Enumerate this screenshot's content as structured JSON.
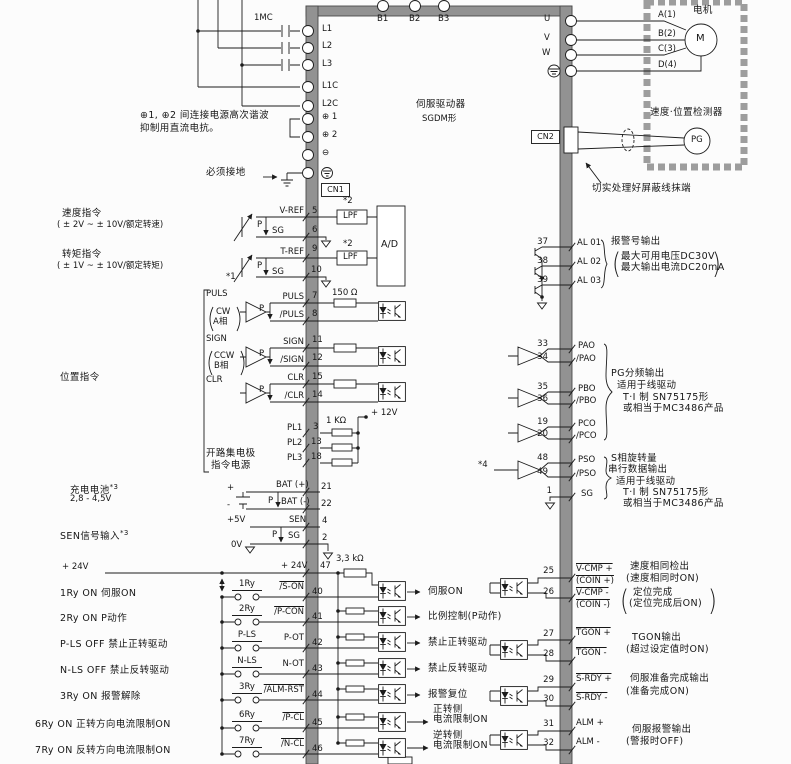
{
  "driver": {
    "title1": "伺服驱动器",
    "title2": "SGDM形",
    "cn1": "CN1",
    "cn2": "CN2",
    "b_terms": [
      "B1",
      "B2",
      "B3"
    ]
  },
  "power": {
    "contactor": "1MC",
    "terminals": [
      "L1",
      "L2",
      "L3",
      "L1C",
      "L2C"
    ],
    "dc_terms": [
      "⊕ 1",
      "⊕ 2",
      "⊖"
    ],
    "reactor_note1": "⊕1, ⊕2 间连接电源高次谐波",
    "reactor_note2": "抑制用直流电抗。",
    "ground_note": "必须接地"
  },
  "motor": {
    "uvw": [
      "U",
      "V",
      "W"
    ],
    "phases": [
      "A(1)",
      "B(2)",
      "C(3)",
      "D(4)"
    ],
    "label": "电机",
    "m": "M",
    "detector": "速度·位置检测器",
    "pg": "PG",
    "shield_note": "切实处理好屏蔽线抹端"
  },
  "analog": {
    "speed_title": "速度指令",
    "speed_range": "( ± 2V ~ ± 10V/额定转速)",
    "torque_title": "转矩指令",
    "torque_range": "( ± 1V ~ ± 10V/额定转矩)",
    "star1": "*1",
    "star2": "*2",
    "lpf": "LPF",
    "ad": "A/D",
    "p": "P",
    "rows": [
      {
        "name": "V-REF",
        "pin": "5"
      },
      {
        "name": "SG",
        "pin": "6"
      },
      {
        "name": "T-REF",
        "pin": "9"
      },
      {
        "name": "SG",
        "pin": "10"
      }
    ]
  },
  "pulse": {
    "section_label": "位置指令",
    "puls": {
      "t": "PULS",
      "s1": "CW",
      "s2": "A相"
    },
    "sign": {
      "t": "SIGN",
      "s1": "CCW",
      "s2": "B相"
    },
    "clr": "CLR",
    "r150": "150 Ω",
    "r1k": "1 KΩ",
    "v12": "+ 12V",
    "p": "P",
    "rows": [
      {
        "name": "PULS",
        "pin": "7"
      },
      {
        "name": "/PULS",
        "pin": "8"
      },
      {
        "name": "SIGN",
        "pin": "11"
      },
      {
        "name": "/SIGN",
        "pin": "12"
      },
      {
        "name": "CLR",
        "pin": "15"
      },
      {
        "name": "/CLR",
        "pin": "14"
      }
    ],
    "pl_rows": [
      {
        "name": "PL1",
        "pin": "3"
      },
      {
        "name": "PL2",
        "pin": "13"
      },
      {
        "name": "PL3",
        "pin": "18"
      }
    ],
    "oc1": "开路集电极",
    "oc2": "指令电源"
  },
  "battery": {
    "label": "充电电池",
    "sup": "*3",
    "range": "2,8 - 4,5V",
    "plus": "+",
    "minus": "-",
    "p": "P",
    "rows": [
      {
        "name": "BAT (+)",
        "pin": "21"
      },
      {
        "name": "BAT (-)",
        "pin": "22"
      }
    ]
  },
  "sen": {
    "label": "SEN信号输入",
    "sup": "*3",
    "v5": "+5V",
    "v0": "0V",
    "p": "P",
    "rows": [
      {
        "name": "SEN",
        "pin": "4"
      },
      {
        "name": "SG",
        "pin": "2"
      }
    ]
  },
  "din": {
    "ext24": "+ 24V",
    "rail24": "+ 24V",
    "pin47": "47",
    "r33": "3,3 kΩ",
    "rows": [
      {
        "ext": "1Ry ON 伺服ON",
        "sw": "1Ry",
        "name": "/S-ON",
        "pin": "40",
        "f1": "伺服ON",
        "f2": ""
      },
      {
        "ext": "2Ry ON P动作",
        "sw": "2Ry",
        "name": "/P-CON",
        "pin": "41",
        "f1": "比例控制(P动作)",
        "f2": ""
      },
      {
        "ext": "P-LS OFF 禁止正转驱动",
        "sw": "P-LS",
        "name": "P-OT",
        "pin": "42",
        "f1": "禁止正转驱动",
        "f2": ""
      },
      {
        "ext": "N-LS OFF 禁止反转驱动",
        "sw": "N-LS",
        "name": "N-OT",
        "pin": "43",
        "f1": "禁止反转驱动",
        "f2": ""
      },
      {
        "ext": "3Ry ON 报警解除",
        "sw": "3Ry",
        "name": "/ALM-RST",
        "pin": "44",
        "f1": "报警复位",
        "f2": ""
      },
      {
        "ext": "6Ry ON 正转方向电流限制ON",
        "sw": "6Ry",
        "name": "/P-CL",
        "pin": "45",
        "f1": "正转侧",
        "f2": "电流限制ON"
      },
      {
        "ext": "7Ry ON 反转方向电流限制ON",
        "sw": "7Ry",
        "name": "/N-CL",
        "pin": "46",
        "f1": "逆转侧",
        "f2": "电流限制ON"
      }
    ]
  },
  "alarm": {
    "rows": [
      {
        "pin": "37",
        "name": "AL 01"
      },
      {
        "pin": "38",
        "name": "AL 02"
      },
      {
        "pin": "39",
        "name": "AL 03"
      }
    ],
    "note": "报警号输出",
    "note2": "最大可用电压DC30V",
    "note3": "最大输出电流DC20mA"
  },
  "pgout": {
    "rows": [
      {
        "pin": "33",
        "name": "PAO"
      },
      {
        "pin": "34",
        "name": "/PAO"
      },
      {
        "pin": "35",
        "name": "PBO"
      },
      {
        "pin": "36",
        "name": "/PBO"
      },
      {
        "pin": "19",
        "name": "PCO"
      },
      {
        "pin": "20",
        "name": "/PCO"
      }
    ],
    "note1": "PG分频输出",
    "note2": "适用于线驱动",
    "note3": "T·I 制 SN75175形",
    "note4": "或相当于MC3486产品",
    "star4": "*4",
    "srows": [
      {
        "pin": "48",
        "name": "PSO"
      },
      {
        "pin": "49",
        "name": "/PSO"
      },
      {
        "pin": "1",
        "name": "SG"
      }
    ],
    "snote1": "S相旋转量",
    "snote2": "串行数据输出",
    "snote3": "适用于线驱动",
    "snote4": "T·I 制 SN75175形",
    "snote5": "或相当于MC3486产品"
  },
  "sout": {
    "g0": {
      "p1": "25",
      "n1": "V-CMP +",
      "s1": "(COIN +)",
      "p2": "26",
      "n2": "V-CMP -",
      "s2": "(COIN -)",
      "note1": "速度相同检出",
      "note2": "(速度相同时ON)",
      "note3": "定位完成",
      "note4": "(定位完成后ON)"
    },
    "g1": {
      "p1": "27",
      "n1": "TGON +",
      "p2": "28",
      "n2": "TGON -",
      "note1": "TGON输出",
      "note2": "(超过设定值时ON)"
    },
    "g2": {
      "p1": "29",
      "n1": "S-RDY +",
      "p2": "30",
      "n2": "S-RDY -",
      "note1": "伺服准备完成输出",
      "note2": "(准备完成ON)"
    },
    "g3": {
      "p1": "31",
      "n1": "ALM +",
      "p2": "32",
      "n2": "ALM -",
      "note1": "伺服报警输出",
      "note2": "(警报时OFF)"
    }
  }
}
